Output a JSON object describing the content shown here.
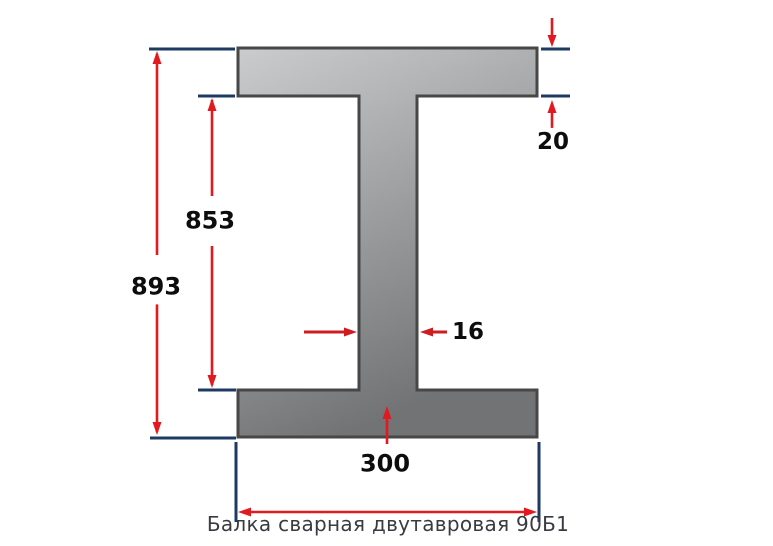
{
  "caption": "Балка сварная двутавровая 90Б1",
  "dimensions": {
    "overall_height": "893",
    "inner_web_height": "853",
    "flange_thickness": "20",
    "web_thickness": "16",
    "flange_width": "300"
  },
  "colors": {
    "background": "#ffffff",
    "beam_gradient_light": "#cbccce",
    "beam_gradient_dark": "#717375",
    "beam_outline": "#474747",
    "dimension_line_navy": "#1d3a63",
    "arrow_red": "#e2191f",
    "arrow_red_dark": "#cf1c20",
    "label_text": "#0d0d0d",
    "caption_text": "#383c42"
  }
}
